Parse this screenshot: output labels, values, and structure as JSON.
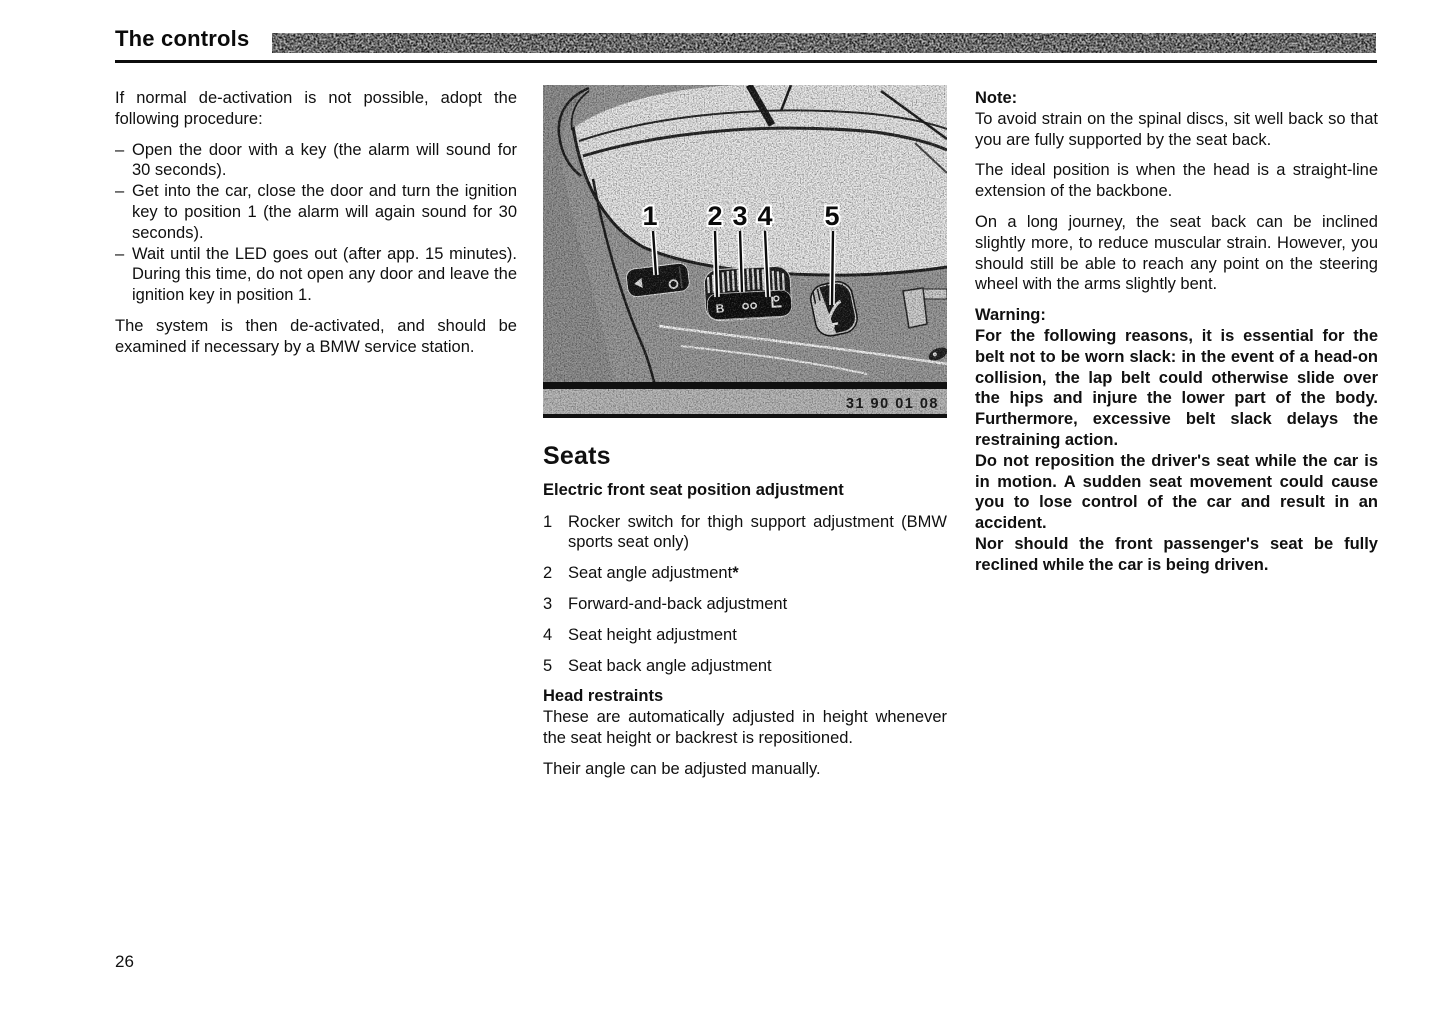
{
  "header": {
    "title": "The controls"
  },
  "page": {
    "number": "26"
  },
  "left_column": {
    "intro": "If normal de-activation is not possible, adopt the following procedure:",
    "bullet_marker": "–",
    "bullets": [
      "Open the door with a key (the alarm will sound for 30 seconds).",
      "Get into the car, close the door and turn the ignition key to position 1 (the alarm will again sound for 30 seconds).",
      "Wait until the LED goes out (after app. 15 minutes). During this time, do not open any door and leave the ignition key in position 1."
    ],
    "closing": "The system is then de-activated, and should be examined if necessary by a BMW service station."
  },
  "figure": {
    "ref_number": "31 90 01 08",
    "callouts": [
      "1",
      "2",
      "3",
      "4",
      "5"
    ],
    "description": "Side view of front seat showing electric adjustment switches"
  },
  "seats": {
    "title": "Seats",
    "subtitle": "Electric front seat position adjustment",
    "items": [
      {
        "num": "1",
        "text": "Rocker switch for thigh support adjustment (BMW sports seat only)",
        "suffix": ""
      },
      {
        "num": "2",
        "text": "Seat angle adjustment",
        "suffix": "*"
      },
      {
        "num": "3",
        "text": "Forward-and-back adjustment",
        "suffix": ""
      },
      {
        "num": "4",
        "text": "Seat height adjustment",
        "suffix": ""
      },
      {
        "num": "5",
        "text": "Seat back angle adjustment",
        "suffix": ""
      }
    ],
    "head_restraints": {
      "title": "Head restraints",
      "body": "These are automatically adjusted in height whenever the seat height or backrest is repositioned.",
      "note": "Their angle can be adjusted manually."
    }
  },
  "right_column": {
    "note": {
      "title": "Note:",
      "paragraphs": [
        "To avoid strain on the spinal discs, sit well back so that you are fully supported by the seat back.",
        "The ideal position is when the head is a straight-line extension of the backbone.",
        "On a long journey, the seat back can be inclined slightly more, to reduce muscular strain. However, you should still be able to reach any point on the steering wheel with the arms slightly bent."
      ]
    },
    "warning": {
      "title": "Warning:",
      "paragraphs": [
        "For the following reasons, it is essential for the belt not to be worn slack: in the event of a head-on collision, the lap belt could otherwise slide over the hips and injure the lower part of the body. Furthermore, excessive belt slack delays the restraining action.",
        "Do not reposition the driver's seat while the car is in motion. A sudden seat movement could cause you to lose control of the car and result in an accident.",
        "Nor should the front passenger's seat be fully reclined while the car is being driven."
      ]
    }
  }
}
